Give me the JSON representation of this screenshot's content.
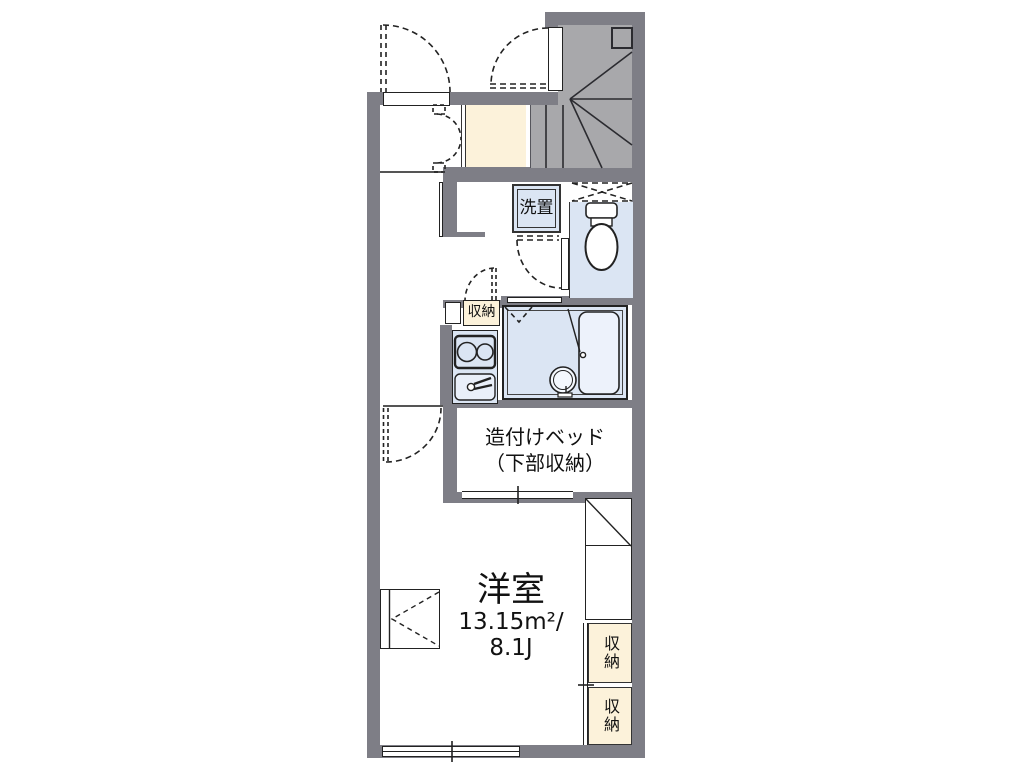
{
  "title": "1K apartment floor plan",
  "colors": {
    "wall": "#7e7e86",
    "stairs": "#a8a8ab",
    "water_blue": "#dbe5f3",
    "storage_cream": "#fcf2da",
    "line": "#222222"
  },
  "rooms": {
    "washer": {
      "label": "洗置"
    },
    "kitchen_storage": {
      "label": "収納"
    },
    "built_in_bed": {
      "label_line1": "造付けベッド",
      "label_line2": "（下部収納）"
    },
    "western_room": {
      "name": "洋室",
      "area_m2": "13.15m²/",
      "area_jo": "8.1J"
    },
    "closet_upper": {
      "label": "収納"
    },
    "closet_lower": {
      "label": "収納"
    }
  }
}
